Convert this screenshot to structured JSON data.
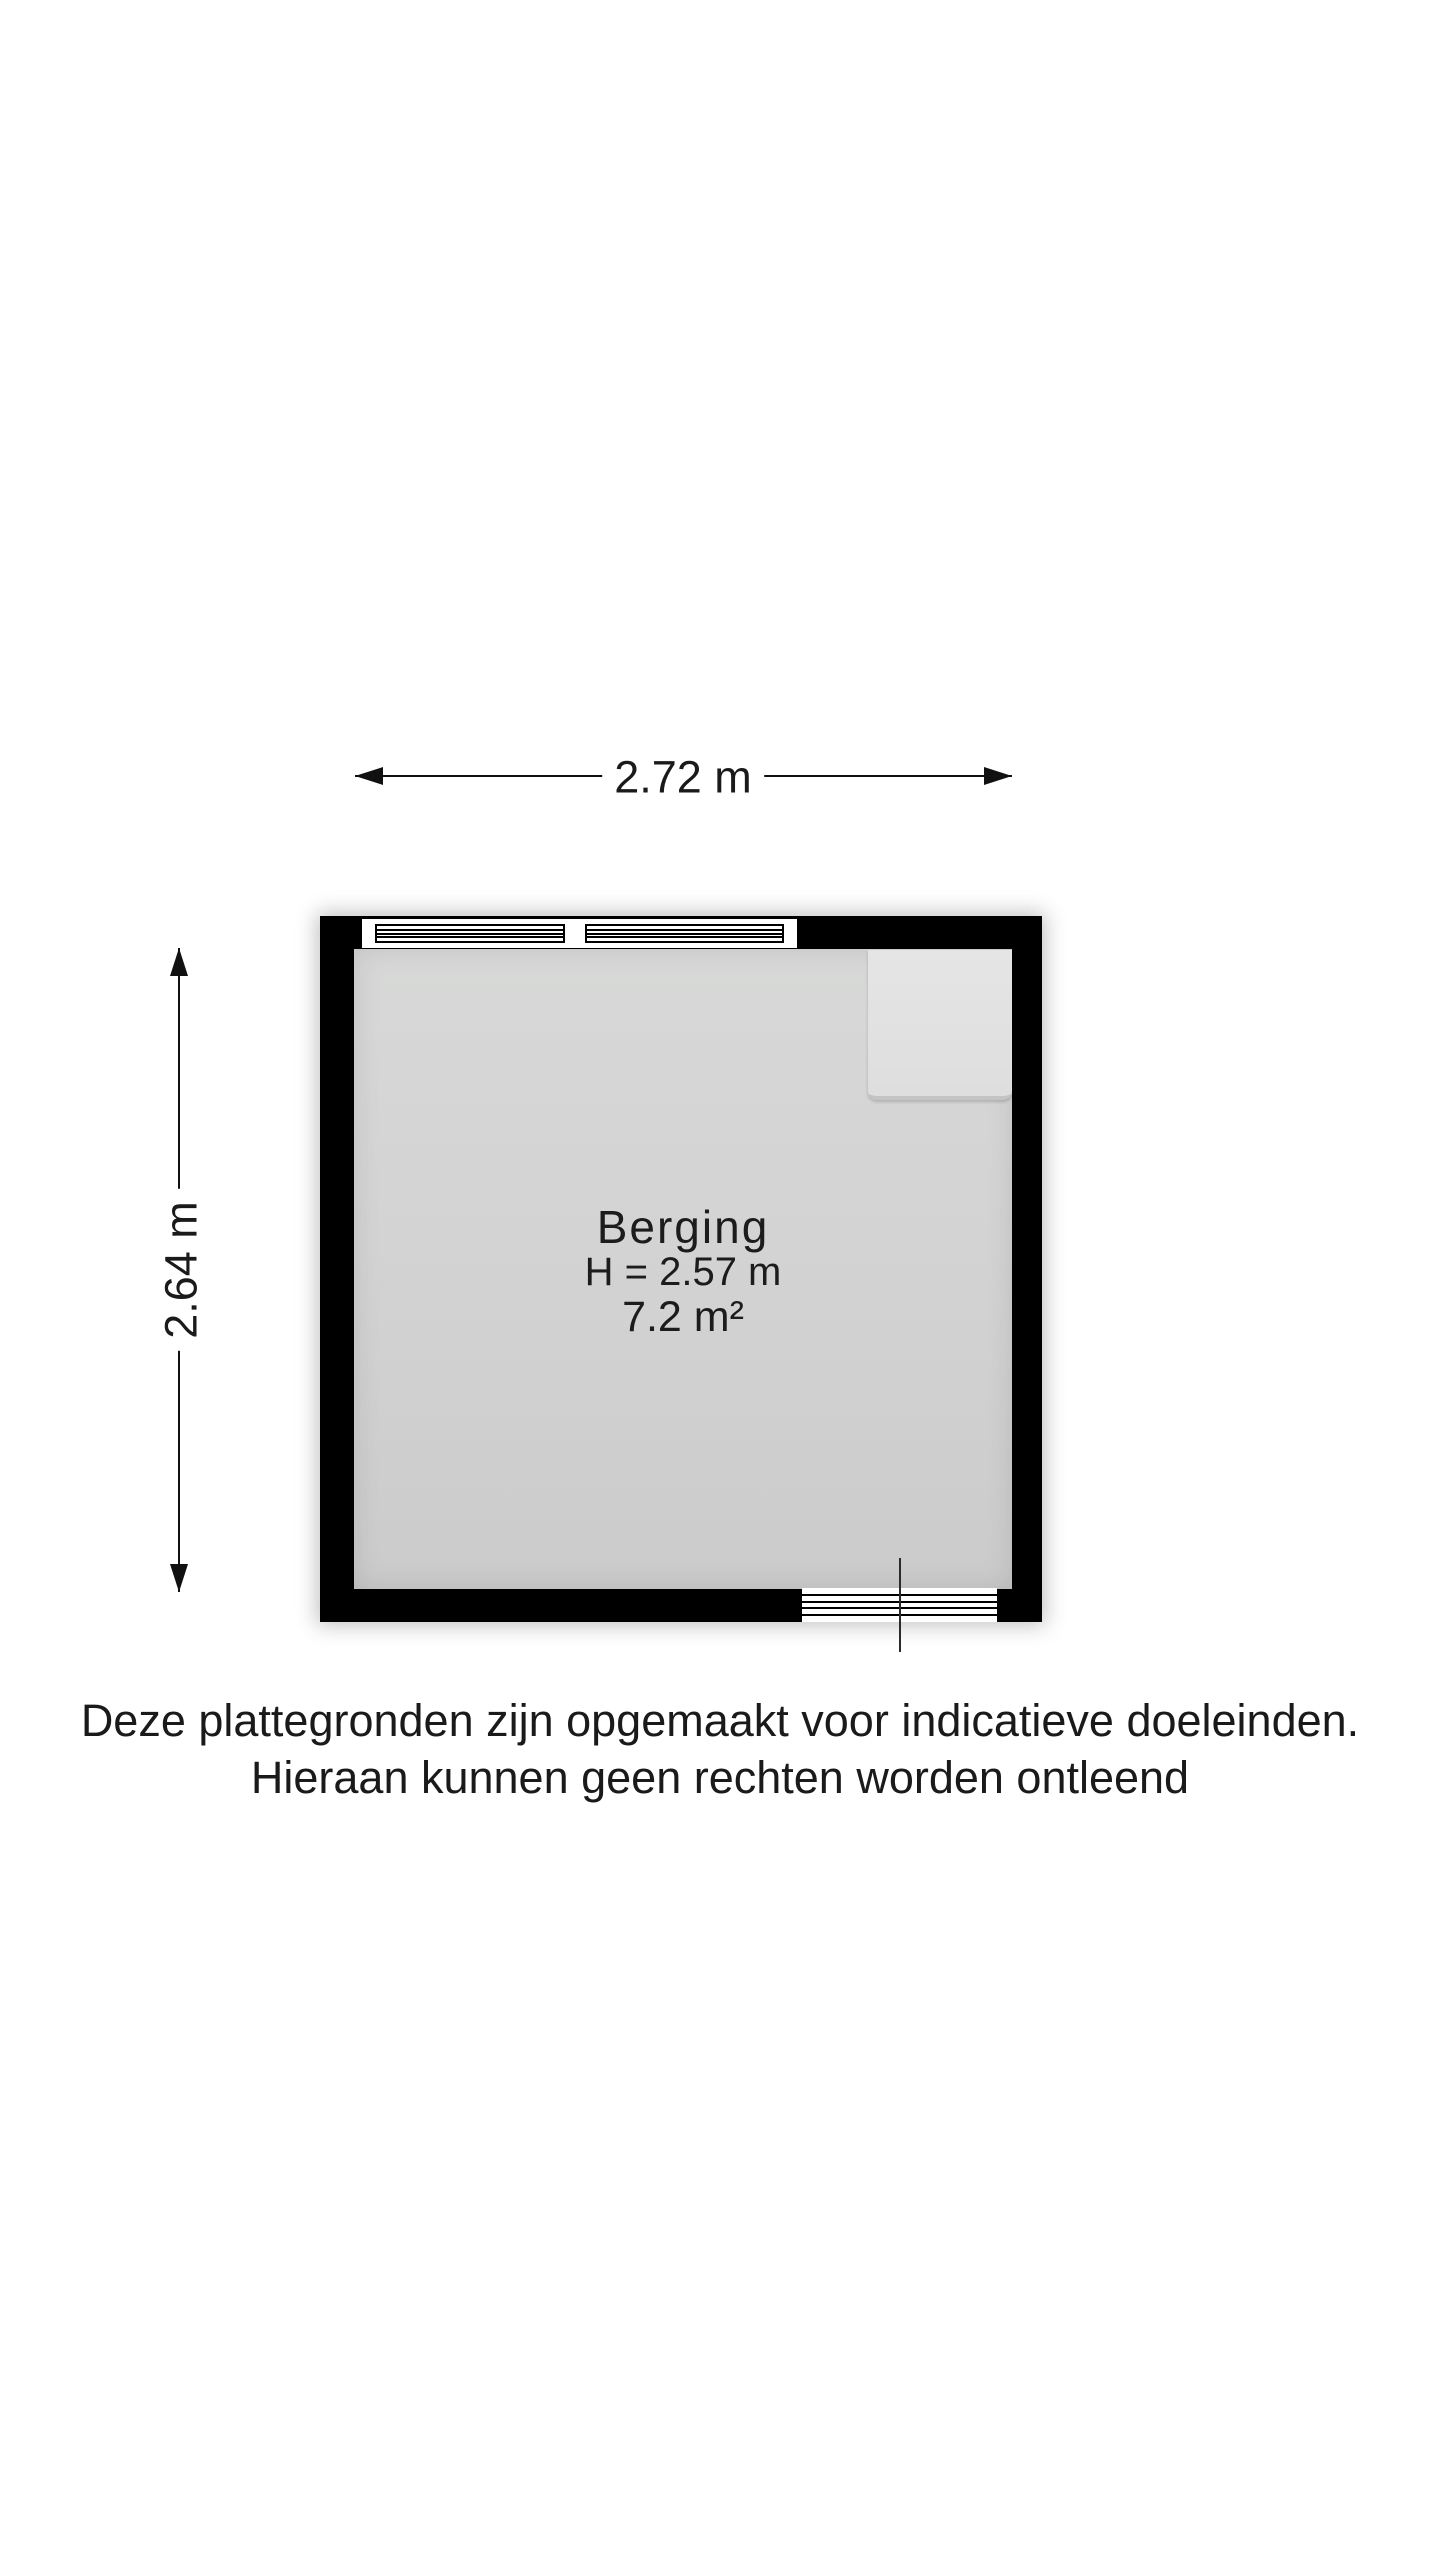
{
  "dimensions": {
    "width": {
      "label": "2.72 m"
    },
    "height": {
      "label": "2.64 m"
    }
  },
  "room": {
    "name": "Berging",
    "ceiling_height": "H = 2.57 m",
    "area": "7.2 m²"
  },
  "disclaimer": {
    "line1": "Deze plattegronden zijn opgemaakt voor indicatieve doeleinden.",
    "line2": "Hieraan kunnen geen rechten worden ontleend"
  },
  "colors": {
    "wall": "#000000",
    "floor": "#d2d2d2",
    "fixture": "#e2e2e2",
    "window_door": "#ffffff",
    "text": "#1a1a1a",
    "background": "#ffffff"
  }
}
